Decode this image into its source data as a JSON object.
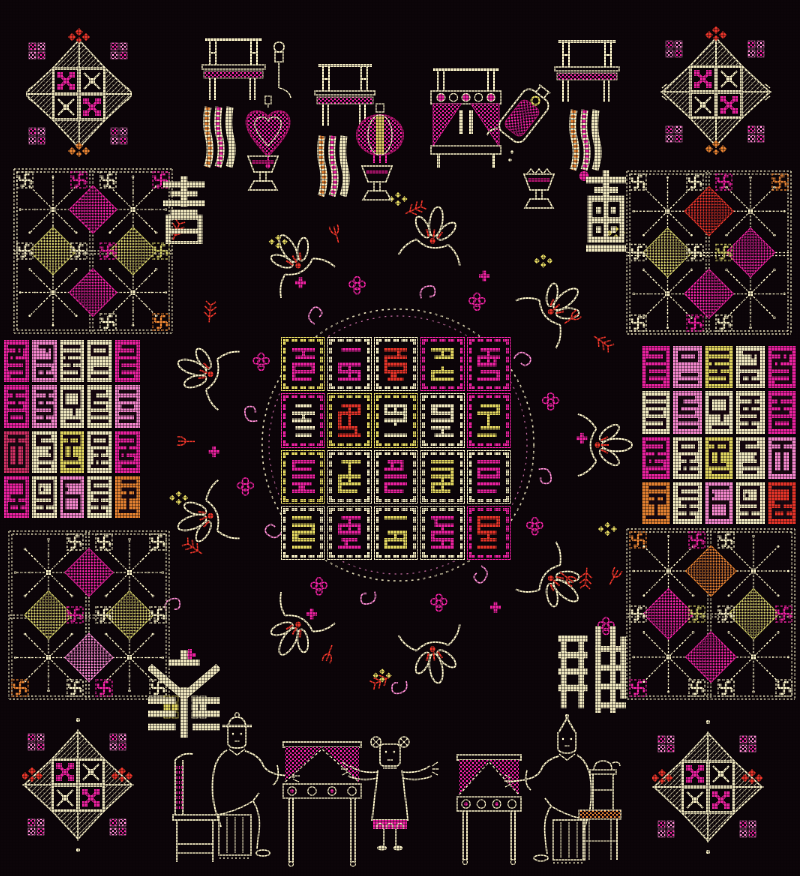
{
  "canvas": {
    "width": 800,
    "height": 876,
    "background": "#0c0509"
  },
  "palette": {
    "cream": "#ece4bc",
    "yellow": "#ddd15e",
    "olive": "#c6c163",
    "magenta": "#e5219c",
    "deep_magenta": "#b0156e",
    "pink": "#ef84c8",
    "red": "#e03328",
    "crimson": "#cb2f63",
    "orange": "#de7e30",
    "ink_dark": "#1a0912"
  },
  "four_arts_characters": {
    "top_left": "書",
    "top_right": "畵",
    "bottom_left": "琴",
    "bottom_right": "棋"
  },
  "wan_symbol": "卍",
  "center_grid": {
    "rows": 4,
    "cols": 5,
    "cells": [
      [
        {
          "ch": "孝",
          "ink": "magenta",
          "frame": "yellow"
        },
        {
          "ch": "夫",
          "ink": "magenta",
          "frame": "cream"
        },
        {
          "ch": "自",
          "ink": "red",
          "frame": "cream"
        },
        {
          "ch": "順",
          "ink": "yellow",
          "frame": "magenta"
        },
        {
          "ch": "國",
          "ink": "magenta",
          "frame": "magenta"
        }
      ],
      [
        {
          "ch": "父",
          "ink": "cream",
          "frame": "magenta"
        },
        {
          "ch": "禍",
          "ink": "red",
          "frame": "yellow"
        },
        {
          "ch": "安",
          "ink": "cream",
          "frame": "yellow"
        },
        {
          "ch": "官",
          "ink": "cream",
          "frame": "cream"
        },
        {
          "ch": "正",
          "ink": "yellow",
          "frame": "magenta"
        }
      ],
      [
        {
          "ch": "心",
          "ink": "magenta",
          "frame": "yellow"
        },
        {
          "ch": "少",
          "ink": "yellow",
          "frame": "cream"
        },
        {
          "ch": "妻",
          "ink": "magenta",
          "frame": "cream"
        },
        {
          "ch": "清",
          "ink": "yellow",
          "frame": "cream"
        },
        {
          "ch": "天",
          "ink": "magenta",
          "frame": "cream"
        }
      ],
      [
        {
          "ch": "寬",
          "ink": "yellow",
          "frame": "cream"
        },
        {
          "ch": "子",
          "ink": "magenta",
          "frame": "cream"
        },
        {
          "ch": "賢",
          "ink": "yellow",
          "frame": "cream"
        },
        {
          "ch": "民",
          "ink": "magenta",
          "frame": "cream"
        },
        {
          "ch": "星",
          "ink": "red",
          "frame": "magenta"
        }
      ]
    ]
  },
  "left_seal_grid": {
    "rows": 4,
    "cols": 5,
    "cells": [
      [
        {
          "ch": "上",
          "bg": "magenta"
        },
        {
          "ch": "吉",
          "bg": "pink"
        },
        {
          "ch": "再",
          "bg": "cream"
        },
        {
          "ch": "過",
          "bg": "cream"
        },
        {
          "ch": "肖",
          "bg": "magenta"
        }
      ],
      [
        {
          "ch": "難",
          "bg": "magenta"
        },
        {
          "ch": "釣",
          "bg": "pink"
        },
        {
          "ch": "未",
          "bg": "cream"
        },
        {
          "ch": "青",
          "bg": "cream"
        },
        {
          "ch": "田",
          "bg": "pink"
        }
      ],
      [
        {
          "ch": "迫",
          "bg": "crimson"
        },
        {
          "ch": "詩",
          "bg": "cream"
        },
        {
          "ch": "寓",
          "bg": "yellow"
        },
        {
          "ch": "書",
          "bg": "cream"
        },
        {
          "ch": "草",
          "bg": "magenta"
        }
      ],
      [
        {
          "ch": "回",
          "bg": "magenta"
        },
        {
          "ch": "馬",
          "bg": "cream"
        },
        {
          "ch": "前",
          "bg": "pink"
        },
        {
          "ch": "示",
          "bg": "cream"
        },
        {
          "ch": "間",
          "bg": "orange"
        }
      ]
    ]
  },
  "right_seal_grid": {
    "rows": 4,
    "cols": 5,
    "cells": [
      [
        {
          "ch": "肖",
          "bg": "magenta"
        },
        {
          "ch": "過",
          "bg": "pink"
        },
        {
          "ch": "再",
          "bg": "yellow"
        },
        {
          "ch": "吉",
          "bg": "cream"
        },
        {
          "ch": "上",
          "bg": "magenta"
        }
      ],
      [
        {
          "ch": "田",
          "bg": "cream"
        },
        {
          "ch": "青",
          "bg": "pink"
        },
        {
          "ch": "未",
          "bg": "cream"
        },
        {
          "ch": "釣",
          "bg": "cream"
        },
        {
          "ch": "難",
          "bg": "magenta"
        }
      ],
      [
        {
          "ch": "草",
          "bg": "magenta"
        },
        {
          "ch": "書",
          "bg": "cream"
        },
        {
          "ch": "寓",
          "bg": "yellow"
        },
        {
          "ch": "詩",
          "bg": "cream"
        },
        {
          "ch": "迫",
          "bg": "pink"
        }
      ],
      [
        {
          "ch": "間",
          "bg": "orange"
        },
        {
          "ch": "示",
          "bg": "cream"
        },
        {
          "ch": "前",
          "bg": "pink"
        },
        {
          "ch": "馬",
          "bg": "cream"
        },
        {
          "ch": "回",
          "bg": "red"
        }
      ]
    ]
  },
  "snowflake_panels": {
    "left_upper": {
      "accents": [
        "magenta",
        "olive",
        "olive",
        "magenta"
      ]
    },
    "left_lower": {
      "accents": [
        "magenta",
        "olive",
        "olive",
        "pink"
      ]
    },
    "right_upper": {
      "accents": [
        "red",
        "olive",
        "magenta",
        "magenta"
      ]
    },
    "right_lower": {
      "accents": [
        "orange",
        "magenta",
        "olive",
        "magenta"
      ]
    }
  },
  "corner_stars": {
    "top_left": {
      "florets": "tb"
    },
    "top_right": {
      "florets": "tb"
    },
    "bottom_left": {
      "florets": "lr"
    },
    "bottom_right": {
      "florets": "lr"
    }
  },
  "motifs": {
    "corner_star": "eight-pointed-star-medallion",
    "snowflake_panel": "snowflake-lattice-with-wan-symbols",
    "wreath": "floral-wreath-ring",
    "top_scene": "altar-tables-lanterns-ewer-goblets",
    "bottom_scene": "seated-elders-child-draped-tables"
  }
}
